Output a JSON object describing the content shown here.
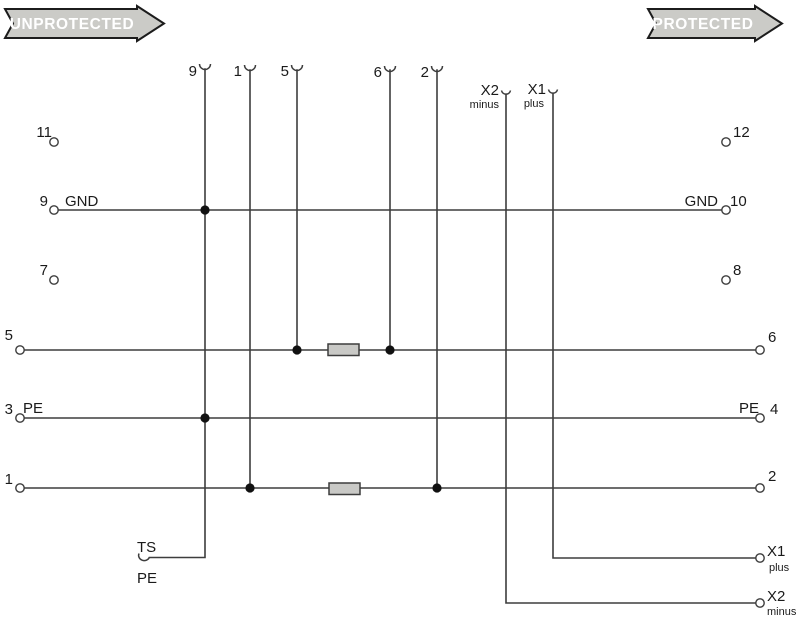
{
  "banners": {
    "unprotected": "UNPROTECTED",
    "protected": "PROTECTED"
  },
  "colors": {
    "background": "#ffffff",
    "wire": "#3d3d3d",
    "dot": "#111111",
    "text": "#1a1a1a",
    "resistor_fill": "#c9c9c6",
    "banner_fill": "#cbcbc7",
    "banner_border": "#1c1c1c",
    "banner_text": "#ffffff"
  },
  "top_terminals": {
    "t9": {
      "label": "9"
    },
    "t1": {
      "label": "1"
    },
    "t5": {
      "label": "5"
    },
    "t6": {
      "label": "6"
    },
    "t2": {
      "label": "2"
    },
    "x2": {
      "label": "X2",
      "sub": "minus"
    },
    "x1": {
      "label": "X1",
      "sub": "plus"
    }
  },
  "left_terminals": {
    "t11": "11",
    "t9": "9",
    "t9_signal": "GND",
    "t7": "7",
    "t5": "5",
    "t3": "3",
    "t3_signal": "PE",
    "t1": "1"
  },
  "right_terminals": {
    "t12": "12",
    "t10": "10",
    "t10_signal": "GND",
    "t8": "8",
    "t6": "6",
    "t4": "4",
    "t4_signal": "PE",
    "t2": "2",
    "x1": {
      "label": "X1",
      "sub": "plus"
    },
    "x2": {
      "label": "X2",
      "sub": "minus"
    }
  },
  "bottom_terminal": {
    "label": "TS",
    "sub": "PE"
  }
}
